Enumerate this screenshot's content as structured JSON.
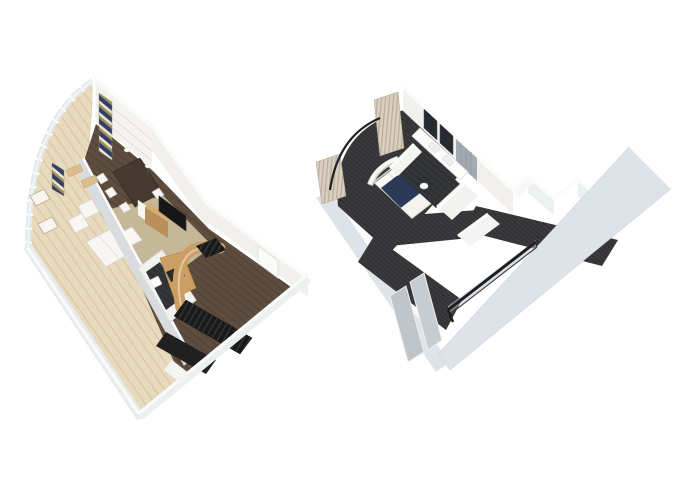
{
  "scene": {
    "kind": "3d-floorplan-rendering",
    "background": "#ffffff",
    "panels": [
      {
        "id": "lower",
        "name": "lower-level-floorplan",
        "features": [
          "curved-balcony-deck",
          "balcony-railing",
          "lounge-chairs",
          "striped-curtains",
          "dining-table",
          "dining-chairs",
          "pendant-lamps",
          "tv-console",
          "tv",
          "sofa",
          "armchairs",
          "ottoman",
          "area-rug",
          "bathroom-pod",
          "curved-stair-wall",
          "staircase",
          "entry-door",
          "entry-hall"
        ]
      },
      {
        "id": "upper",
        "name": "upper-level-floorplan",
        "features": [
          "bedroom-carpet",
          "bed",
          "headboard",
          "pillows",
          "drape-curtains",
          "curtain-rail",
          "vanity-mirrors",
          "vanity-counter",
          "mosaic-tile-wall",
          "bathroom-floor",
          "hallway",
          "wardrobe",
          "wood-staircase",
          "overlook-railing",
          "glass-shower-panels"
        ]
      }
    ]
  },
  "colors": {
    "bg": "#ffffff",
    "wall_top": "#fbfbfa",
    "wall_face": "#f1f0ed",
    "wall_face_warm": "#f4f3f0",
    "wall_face_cool": "#edf0f1",
    "wall_outer": "#dde3e8",
    "wall_outer_light": "#e9eced",
    "divider_wall": "#d9dcdf",
    "deck_wood": "#e9dabd",
    "deck_wood_line": "#d8c5a3",
    "floor_wood": "#5e4d3f",
    "floor_wood_line": "#4f4234",
    "carpet_beige": "#c5b899",
    "carpet_trim": "#b7aa8b",
    "carpet_dark": "#3a3a3c",
    "carpet_dark_line": "#2e2e30",
    "stair_dark": "#1a1a1a",
    "stair_tread": "#373737",
    "stair_wood": "#e0cda8",
    "stair_wood_line": "#b49a6e",
    "wood_wall": "#cb9e63",
    "wood_wall_light": "#e6d3ae",
    "wood_cabinet": "#b98e58",
    "wood_cabinet_top": "#d4ad76",
    "table_wood": "#463a2f",
    "navy": "#2c3a58",
    "curtain_navy": "#323e66",
    "curtain_cream": "#ece5d3",
    "curtain_gold": "#9f8f5d",
    "drape": "#d9cfc0",
    "drape_line": "#b9ac98",
    "white_furniture": "#f7f6f3",
    "tv": "#161616",
    "tile_dark": "#2f3133",
    "tile_line": "#3b3e41",
    "mosaic": "#a2aaae",
    "mirror": "#262b31",
    "glass": "#bfc5c9",
    "glass_light": "#c6ccd0",
    "railing": "#1b1c1e",
    "wardrobe": "#d6c2a0",
    "counter_dark": "#2b2b2b",
    "lamp": "#fffef2",
    "door_tan": "#dcbd8e"
  }
}
